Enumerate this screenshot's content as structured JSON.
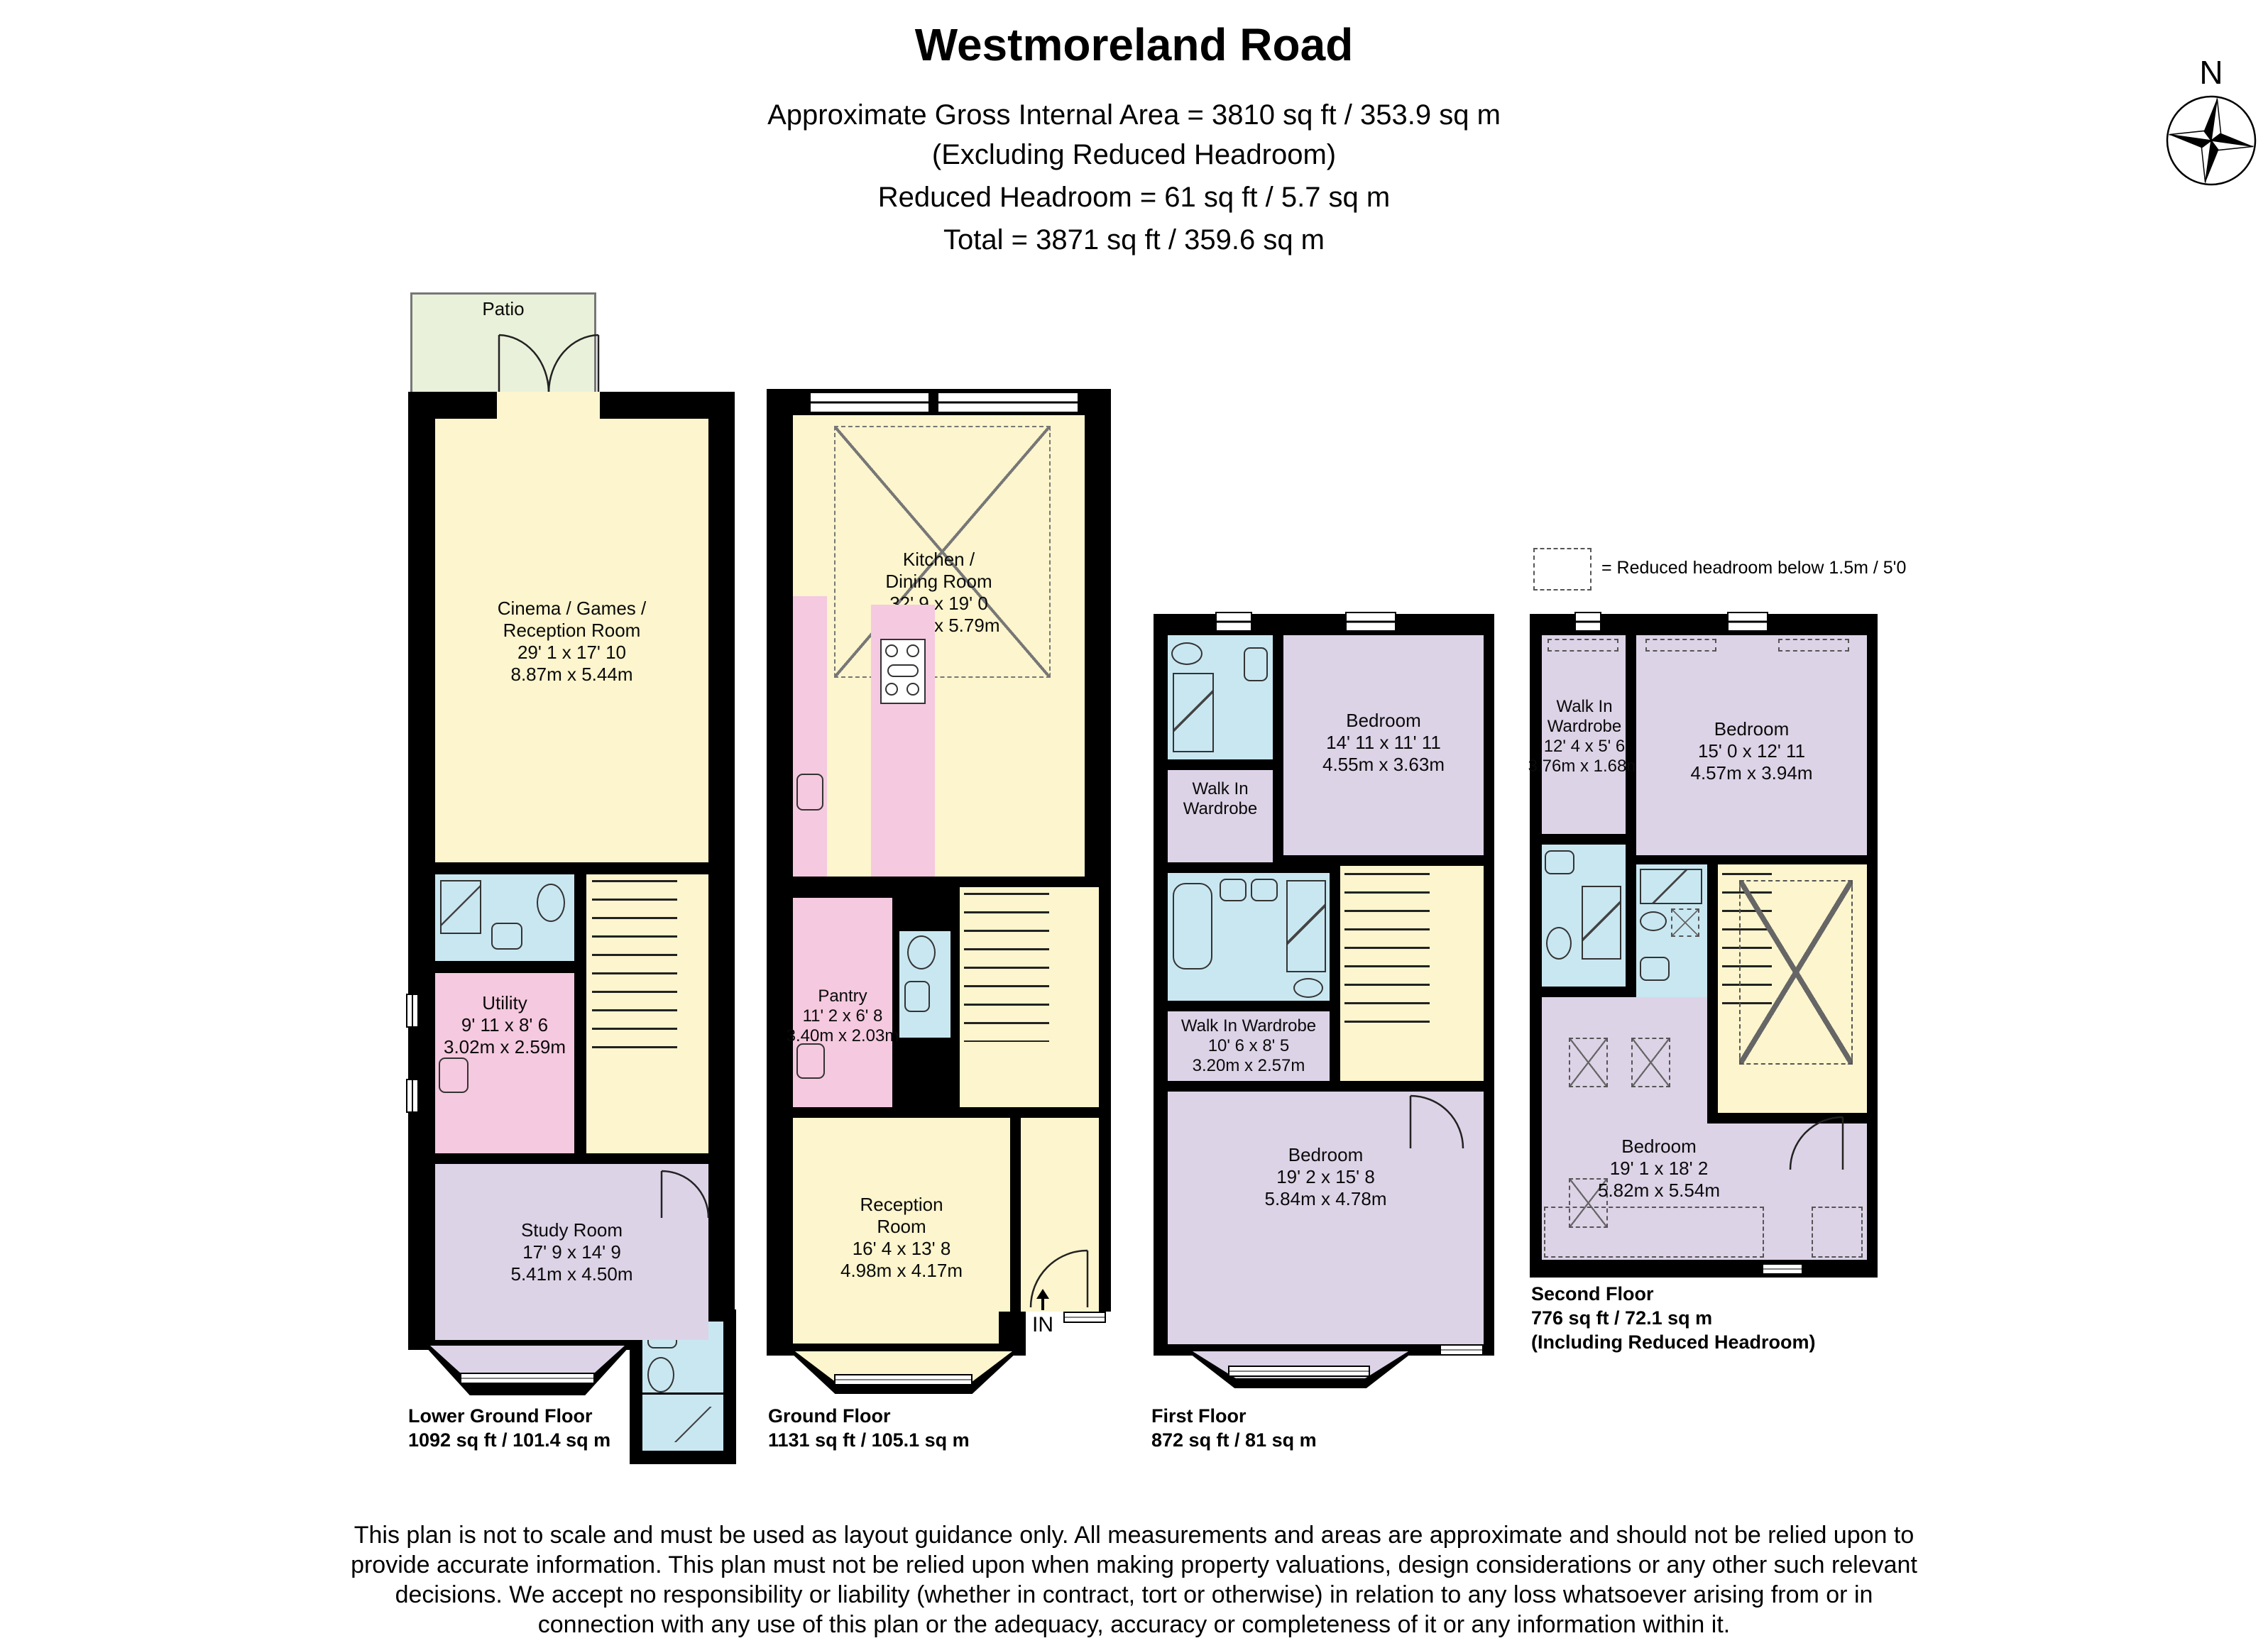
{
  "header": {
    "title": "Westmoreland Road",
    "subtitle1": "Approximate Gross Internal Area = 3810 sq ft / 353.9 sq m",
    "subtitle2": "(Excluding Reduced Headroom)",
    "subtitle3": "Reduced Headroom = 61 sq ft / 5.7 sq m",
    "subtitle4": "Total = 3871 sq ft / 359.6 sq m"
  },
  "compass": {
    "north_label": "N"
  },
  "legend": {
    "label": "= Reduced headroom below 1.5m / 5'0"
  },
  "floors": {
    "lower_ground": {
      "label": "Lower Ground Floor",
      "area": "1092 sq ft / 101.4 sq m",
      "patio": "Patio",
      "cinema": {
        "l1": "Cinema / Games /",
        "l2": "Reception Room",
        "ft": "29' 1 x 17' 10",
        "m": "8.87m x 5.44m"
      },
      "utility": {
        "l1": "Utility",
        "ft": "9' 11 x 8' 6",
        "m": "3.02m x 2.59m"
      },
      "study": {
        "l1": "Study Room",
        "ft": "17' 9 x 14' 9",
        "m": "5.41m x 4.50m"
      }
    },
    "ground": {
      "label": "Ground Floor",
      "area": "1131 sq ft / 105.1 sq m",
      "kitchen": {
        "l1": "Kitchen /",
        "l2": "Dining Room",
        "ft": "32' 9 x 19' 0",
        "m": "9.98m x 5.79m"
      },
      "pantry": {
        "l1": "Pantry",
        "ft": "11' 2 x 6' 8",
        "m": "3.40m x 2.03m"
      },
      "reception": {
        "l1": "Reception",
        "l2": "Room",
        "ft": "16' 4 x 13' 8",
        "m": "4.98m x 4.17m"
      },
      "entrance": "IN"
    },
    "first": {
      "label": "First Floor",
      "area": "872 sq ft / 81 sq m",
      "bedroom1": {
        "l1": "Bedroom",
        "ft": "14' 11 x 11' 11",
        "m": "4.55m x 3.63m"
      },
      "wiw1": {
        "l1": "Walk In",
        "l2": "Wardrobe"
      },
      "wiw2": {
        "l1": "Walk In Wardrobe",
        "ft": "10' 6 x 8' 5",
        "m": "3.20m x 2.57m"
      },
      "bedroom2": {
        "l1": "Bedroom",
        "ft": "19' 2 x 15' 8",
        "m": "5.84m x 4.78m"
      }
    },
    "second": {
      "label": "Second Floor",
      "area": "776 sq ft / 72.1 sq m",
      "note": "(Including Reduced Headroom)",
      "wiw": {
        "l1": "Walk In",
        "l2": "Wardrobe",
        "ft": "12' 4 x 5' 6",
        "m": "3.76m x 1.68m"
      },
      "bedroom1": {
        "l1": "Bedroom",
        "ft": "15' 0 x 12' 11",
        "m": "4.57m x 3.94m"
      },
      "bedroom2": {
        "l1": "Bedroom",
        "ft": "19' 1 x 18' 2",
        "m": "5.82m x 5.54m"
      }
    }
  },
  "disclaimer": {
    "lines": [
      "This plan is not to scale and must be used as layout guidance only. All measurements and areas are approximate and should not be relied upon to",
      "provide accurate information. This plan must not be relied upon when making property valuations, design considerations or any other such relevant",
      "decisions. We accept no responsibility or liability (whether in contract, tort or otherwise) in relation to any loss whatsoever arising from or in",
      "connection with any use of this plan or the adequacy, accuracy or completeness of it or any information within it."
    ]
  },
  "colors": {
    "room_yellow": "#FCF5CD",
    "room_purple": "#DDD3E7",
    "room_pink": "#F5C9DF",
    "room_blue": "#C9E7F1",
    "patio_green": "#EAF1DA",
    "wall": "#000000"
  }
}
